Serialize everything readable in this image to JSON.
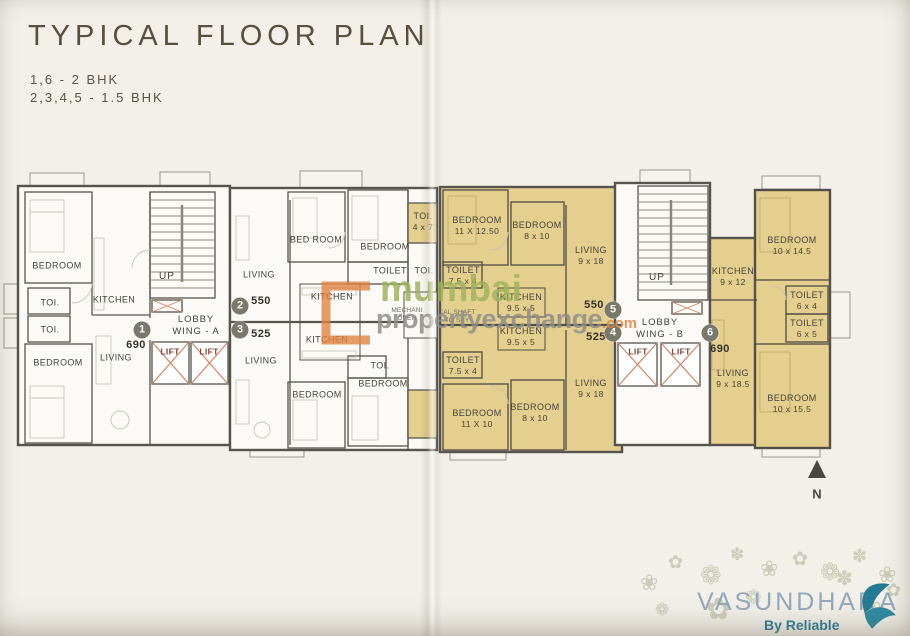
{
  "header": {
    "title": "TYPICAL FLOOR PLAN",
    "line1": "1,6 - 2 BHK",
    "line2": "2,3,4,5 - 1.5 BHK"
  },
  "units": {
    "u1": {
      "badge": "1",
      "area": "690",
      "bedroom_top": "BEDROOM",
      "toi1": "TOI.",
      "toi2": "TOI.",
      "kitchen": "KITCHEN",
      "living": "LIVING",
      "bedroom_bottom": "BEDROOM"
    },
    "u2": {
      "badge": "2",
      "area": "550",
      "living": "LIVING",
      "bedroom1": "BED ROOM",
      "bedroom2": "BEDROOM",
      "toilet": "TOILET",
      "kitchen": "KITCHEN"
    },
    "u3": {
      "badge": "3",
      "area": "525",
      "kitchen": "KITCHEN",
      "living": "LIVING",
      "toi": "TOI.",
      "bedroom_right": "BEDROOM",
      "bedroom_bottom": "BEDROOM"
    },
    "u4": {
      "badge": "4",
      "area": "525",
      "toilet": "TOILET",
      "toilet_dim": "7.5 x 4",
      "kitchen": "KITCHEN",
      "kitchen_dim": "9.5 x 5",
      "living": "LIVING",
      "living_dim": "9 x 18",
      "bedroom1": "BEDROOM",
      "bedroom1_dim": "11 X 10",
      "bedroom2": "BEDROOM",
      "bedroom2_dim": "8 x 10"
    },
    "u5": {
      "badge": "5",
      "area": "550",
      "bedroom1": "BEDROOM",
      "bedroom1_dim": "11 X 12.50",
      "bedroom2": "BEDROOM",
      "bedroom2_dim": "8 x 10",
      "living": "LIVING",
      "living_dim": "9 x 18",
      "toilet": "TOILET",
      "toilet_dim": "7.5 x 4",
      "kitchen": "KITCHEN",
      "kitchen_dim": "9.5 x 5"
    },
    "u6": {
      "badge": "6",
      "area": "690",
      "kitchen": "KITCHEN",
      "kitchen_dim": "9 x 12",
      "living": "LIVING",
      "living_dim": "9 x 18.5",
      "bedroom1": "BEDROOM",
      "bedroom1_dim": "10 x 14.5",
      "toilet1": "TOILET",
      "toilet1_dim": "6 x 4",
      "toilet2": "TOILET",
      "toilet2_dim": "6 x 5",
      "bedroom2": "BEDROOM",
      "bedroom2_dim": "10 x 15.5"
    }
  },
  "core_a": {
    "up": "UP",
    "lobby_line1": "LOBBY",
    "lobby_line2": "WING - A",
    "lift1": "LIFT",
    "lift2": "LIFT"
  },
  "core_b": {
    "up": "UP",
    "lobby_line1": "LOBBY",
    "lobby_line2": "WING - B",
    "lift1": "LIFT",
    "lift2": "LIFT"
  },
  "shaft": {
    "toi_top": "TOI.",
    "toi_top_dim": "4 x 7",
    "toi_mid": "TOI.",
    "mech_left1": "MECHANI",
    "mech_left2": "OPEN",
    "mech_right1": "CAL SHAFT",
    "mech_right2": "TO SKY"
  },
  "compass": {
    "label": "N"
  },
  "watermark": {
    "word1": "mumbai",
    "word2": "propertyexchange",
    "tld": ".com"
  },
  "brand": {
    "name": "VASUNDHARA",
    "tagline": "By Reliable"
  },
  "colors": {
    "highlight": "#e4cf8e",
    "wall": "#56544c",
    "paper": "#f2f0e9",
    "lift_x": "#cf8663",
    "watermark_green": "#9db35a",
    "watermark_gray": "#8f8e8a",
    "watermark_orange": "#dd8340",
    "brand_blue": "#92a9bd",
    "brand_teal": "#2c7e96"
  }
}
